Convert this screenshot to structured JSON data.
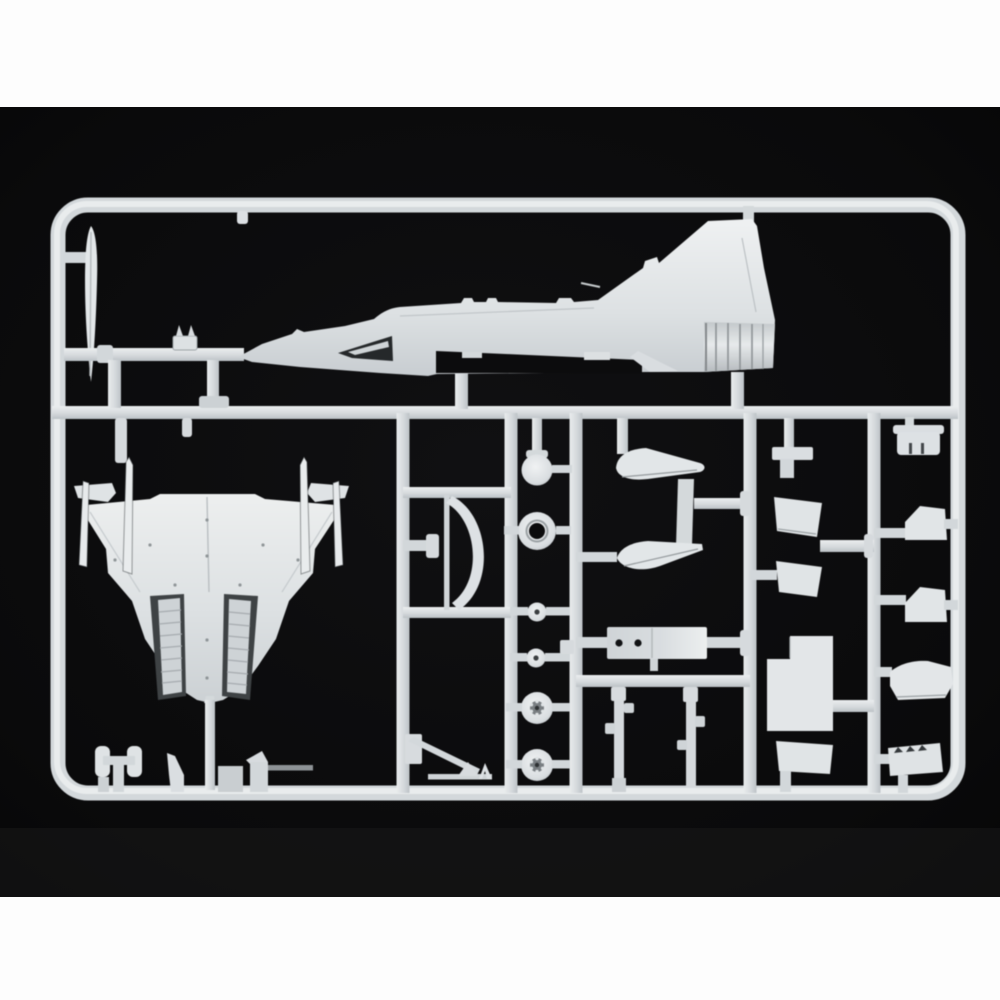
{
  "scene": {
    "description": "Product photograph of a light-grey injection-moulded polystyrene model-kit sprue (jet aircraft parts) on a black backdrop with white bands top and bottom",
    "colors": {
      "band_white": "#fdfdfd",
      "backdrop": "#08080a",
      "backdrop_glow": "#141415",
      "plastic_base": "#d8dcdf",
      "plastic_light": "#eaedee",
      "plastic_mid": "#c7ccd0",
      "plastic_shadow": "#9ba1a5",
      "engrave_dark": "#25282a",
      "bay_dark": "#3e4244",
      "hole_dark": "#0b0b0c",
      "rod_dim": "#8e9396"
    },
    "frame": {
      "left": 51,
      "top": 198,
      "right": 966,
      "bottom": 800,
      "corner_radius": 30,
      "rail_width": 15,
      "mid_rail_y": 406
    },
    "parts": [
      {
        "id": "fuselage-half",
        "label": "fuselage half with swept tail fin and ribbed exhaust nozzle"
      },
      {
        "id": "blade-aerial",
        "label": "long thin blade / aerial"
      },
      {
        "id": "nose-bracket",
        "label": "small two-prong bracket"
      },
      {
        "id": "lower-wing",
        "label": "one-piece delta lower wing with twin gear bays"
      },
      {
        "id": "wingtip-rails",
        "label": "four thin wingtip launch-rail strips"
      },
      {
        "id": "gear-struts",
        "label": "curved undercarriage struts and tow-bar"
      },
      {
        "id": "wheels",
        "label": "six wheels / hub discs"
      },
      {
        "id": "canards",
        "label": "pair of canard foreplanes"
      },
      {
        "id": "equipment-box",
        "label": "cockpit tub / equipment box with two holes"
      },
      {
        "id": "gear-legs",
        "label": "two long undercarriage legs"
      },
      {
        "id": "gear-doors",
        "label": "undercarriage door panels"
      },
      {
        "id": "fittings",
        "label": "small intake / nozzle fittings on right edge"
      }
    ]
  }
}
